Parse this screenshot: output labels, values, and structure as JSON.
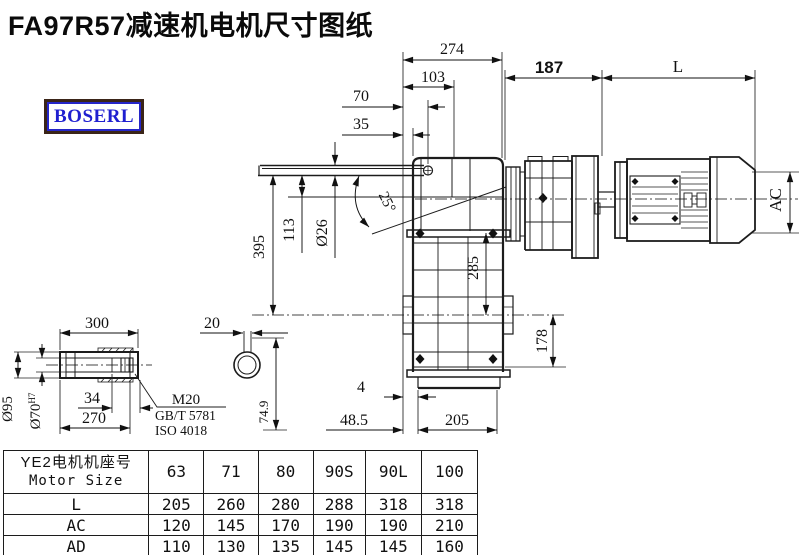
{
  "title": "FA97R57减速机电机尺寸图纸",
  "logo_text": "BOSERL",
  "drawing": {
    "dims": {
      "d274": "274",
      "d103": "103",
      "d70": "70",
      "d35": "35",
      "angle": "25°",
      "arm_dia": "Ø26",
      "d113": "113",
      "d395": "395",
      "d187": "187",
      "motor_length": "L",
      "motor_dia": "AC",
      "d285": "285",
      "d178": "178",
      "d4": "4",
      "d48_5": "48.5",
      "d205": "205"
    },
    "shaft": {
      "d300": "300",
      "d20": "20",
      "d270": "270",
      "d34": "34",
      "outer_dia": "Ø95",
      "bore_dia": "Ø70",
      "bore_tol": "H7",
      "d74_9": "74.9",
      "thread": "M20",
      "std_gb": "GB/T 5781",
      "std_iso": "ISO 4018"
    }
  },
  "table": {
    "header_cn": "YE2电机机座号",
    "header_en": "Motor Size",
    "columns": [
      "63",
      "71",
      "80",
      "90S",
      "90L",
      "100"
    ],
    "rows": [
      {
        "label": "L",
        "values": [
          "205",
          "260",
          "280",
          "288",
          "318",
          "318"
        ]
      },
      {
        "label": "AC",
        "values": [
          "120",
          "145",
          "170",
          "190",
          "190",
          "210"
        ]
      },
      {
        "label": "AD",
        "values": [
          "110",
          "130",
          "135",
          "145",
          "145",
          "160"
        ]
      }
    ]
  }
}
